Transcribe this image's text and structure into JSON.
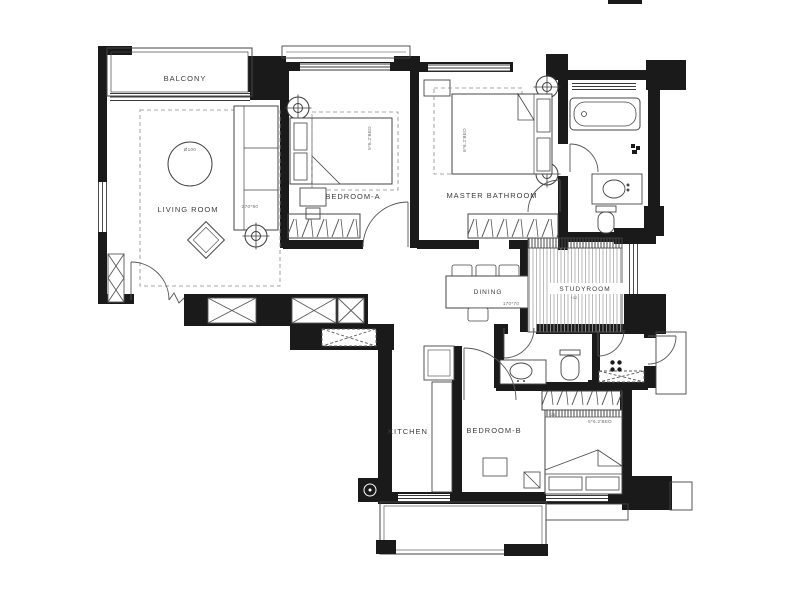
{
  "title": "Apartment floor plan",
  "colors": {
    "wall": "#1a1a1a",
    "line": "#454545",
    "thin_line": "#777777",
    "hatch": "#9a9a9a",
    "background": "#ffffff"
  },
  "rooms": {
    "balcony": {
      "label": "BALCONY"
    },
    "living_room": {
      "label": "LIVING ROOM",
      "rug_dim": "Ø100",
      "sofa_dim": "270*90"
    },
    "bedroom_a": {
      "label": "BEDROOM-A",
      "bed_dim": "5*6.2'BED"
    },
    "master_bedroom": {
      "label": "MASTER BATHROOM",
      "bed_dim": "6*6.2'BED"
    },
    "dining": {
      "label": "DINING",
      "table_dim": "170*70"
    },
    "studyroom": {
      "label": "STUDYROOM",
      "level": "+12"
    },
    "kitchen": {
      "label": "KITCHEN"
    },
    "bedroom_b": {
      "label": "BEDROOM-B",
      "bed_dim": "5*6.2'BED",
      "level": "+25"
    }
  }
}
